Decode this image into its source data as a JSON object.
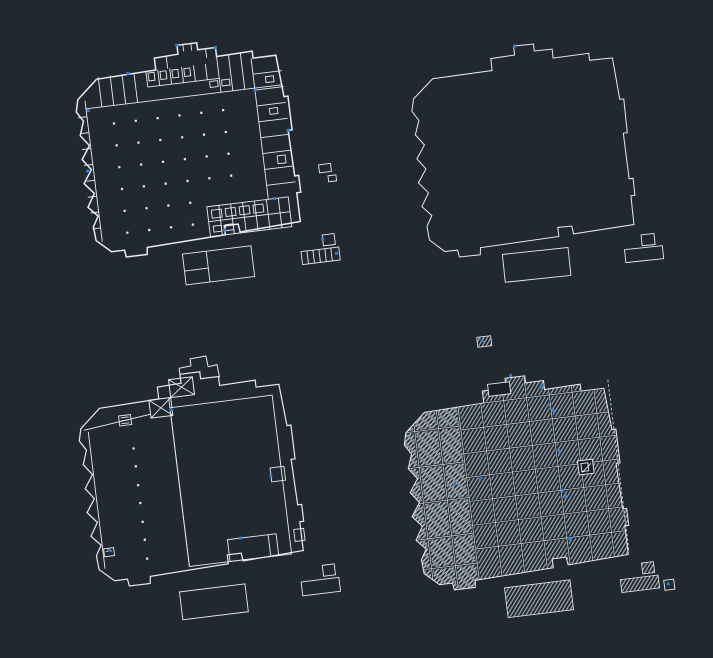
{
  "canvas": {
    "width": 713,
    "height": 658
  },
  "colors": {
    "background": "#212830",
    "line": "#e9ebee",
    "line_dim": "#d6dadf",
    "accent_blue": "#2e7ed2",
    "hatch": "#b9c0c8"
  },
  "footprint_path": "M 28,30 L 88,28 L 88,16 L 112,15 L 112,6 L 132,6 L 132,13 L 150,13 L 150,22 L 186,21 L 186,28 L 209,28 L 212,70 L 216,70 L 216,104 L 212,104 L 213,150 L 217,150 L 217,167 L 213,167 L 213,196 L 152,199 L 151,191 L 137,191 L 137,200 L 58,203 L 57,210 L 36,210 L 35,203 L 22,203 L 8,190 L 7,176 L 13,166 L 4,156 L 12,143 L 3,132 L 12,119 L 4,108 L 13,95 L 5,84 L 10,70 L 4,60 L 7,48 Z",
  "hatch_angles": {
    "left": -27,
    "right": -52
  },
  "plans": [
    {
      "id": "plan-top-left",
      "role": "detailed-floor-plan",
      "transform": "translate(77,39) rotate(-7 108 105)",
      "outline": true,
      "outline_width": 1.5,
      "roof": false,
      "paths": [],
      "lines": [
        [
          14,
          58,
          212,
          58
        ],
        [
          78,
          44,
          150,
          44
        ],
        [
          30,
          28,
          30,
          58
        ],
        [
          42,
          28,
          42,
          58
        ],
        [
          54,
          28,
          54,
          58
        ],
        [
          66,
          28,
          66,
          58
        ],
        [
          78,
          28,
          78,
          44
        ],
        [
          90,
          28,
          90,
          44
        ],
        [
          102,
          28,
          102,
          44
        ],
        [
          114,
          28,
          114,
          44
        ],
        [
          126,
          28,
          126,
          44
        ],
        [
          138,
          28,
          138,
          44
        ],
        [
          150,
          22,
          150,
          58
        ],
        [
          162,
          22,
          162,
          58
        ],
        [
          174,
          22,
          174,
          58
        ],
        [
          100,
          15,
          100,
          28
        ],
        [
          118,
          6,
          118,
          13
        ],
        [
          126,
          6,
          126,
          13
        ],
        [
          140,
          13,
          140,
          22
        ],
        [
          184,
          28,
          184,
          170
        ],
        [
          184,
          44,
          213,
          44
        ],
        [
          184,
          60,
          213,
          60
        ],
        [
          184,
          76,
          213,
          76
        ],
        [
          184,
          92,
          213,
          92
        ],
        [
          184,
          108,
          213,
          108
        ],
        [
          184,
          124,
          213,
          124
        ],
        [
          184,
          140,
          213,
          140
        ],
        [
          184,
          156,
          213,
          156
        ],
        [
          14,
          50,
          14,
          192
        ],
        [
          5,
          66,
          14,
          66
        ],
        [
          5,
          82,
          14,
          82
        ],
        [
          5,
          98,
          14,
          98
        ],
        [
          5,
          114,
          14,
          114
        ],
        [
          6,
          130,
          14,
          130
        ],
        [
          5,
          146,
          14,
          146
        ],
        [
          6,
          162,
          14,
          162
        ],
        [
          6,
          178,
          14,
          178
        ],
        [
          134,
          170,
          134,
          200
        ],
        [
          146,
          170,
          146,
          200
        ],
        [
          158,
          170,
          158,
          200
        ],
        [
          170,
          170,
          170,
          200
        ],
        [
          182,
          170,
          182,
          200
        ],
        [
          194,
          170,
          194,
          200
        ],
        [
          122,
          185,
          204,
          185
        ],
        [
          116,
          214,
          116,
          245
        ],
        [
          92,
          231,
          116,
          231
        ],
        [
          216,
          226,
          216,
          239
        ],
        [
          222,
          226,
          222,
          239
        ],
        [
          228,
          226,
          228,
          239
        ],
        [
          234,
          226,
          234,
          239
        ],
        [
          240,
          226,
          240,
          239
        ]
      ],
      "rects": [
        [
          122,
          170,
          82,
          30
        ],
        [
          92,
          214,
          69,
          31
        ],
        [
          233,
          212,
          12,
          11
        ],
        [
          210,
          226,
          38,
          13
        ],
        [
          238,
          142,
          12,
          8
        ],
        [
          246,
          154,
          8,
          6
        ],
        [
          80,
          30,
          6,
          8
        ],
        [
          92,
          30,
          6,
          8
        ],
        [
          104,
          30,
          6,
          8
        ],
        [
          116,
          30,
          6,
          8
        ],
        [
          140,
          46,
          8,
          6
        ],
        [
          152,
          46,
          8,
          6
        ],
        [
          196,
          48,
          8,
          6
        ],
        [
          196,
          80,
          8,
          6
        ],
        [
          198,
          128,
          8,
          8
        ],
        [
          126,
          174,
          10,
          8
        ],
        [
          140,
          174,
          10,
          8
        ],
        [
          154,
          174,
          10,
          8
        ],
        [
          168,
          174,
          10,
          8
        ],
        [
          126,
          190,
          8,
          6
        ],
        [
          138,
          190,
          8,
          6
        ]
      ],
      "cross_rects": [],
      "hatch_rects": [],
      "dark_rects": [],
      "dashed": [],
      "dots": [
        [
          40,
          76
        ],
        [
          62,
          76
        ],
        [
          84,
          76
        ],
        [
          106,
          76
        ],
        [
          128,
          76
        ],
        [
          150,
          76
        ],
        [
          40,
          98
        ],
        [
          62,
          98
        ],
        [
          84,
          98
        ],
        [
          106,
          98
        ],
        [
          128,
          98
        ],
        [
          150,
          98
        ],
        [
          40,
          120
        ],
        [
          62,
          120
        ],
        [
          84,
          120
        ],
        [
          106,
          120
        ],
        [
          128,
          120
        ],
        [
          150,
          120
        ],
        [
          40,
          142
        ],
        [
          62,
          142
        ],
        [
          84,
          142
        ],
        [
          106,
          142
        ],
        [
          128,
          142
        ],
        [
          150,
          142
        ],
        [
          40,
          164
        ],
        [
          62,
          164
        ],
        [
          84,
          164
        ],
        [
          106,
          164
        ],
        [
          40,
          186
        ],
        [
          62,
          186
        ],
        [
          84,
          186
        ],
        [
          106,
          186
        ]
      ],
      "blue_dots": [
        [
          16,
          60
        ],
        [
          60,
          28
        ],
        [
          150,
          13
        ],
        [
          184,
          60
        ],
        [
          212,
          104
        ],
        [
          190,
          170
        ],
        [
          137,
          195
        ],
        [
          8,
          120
        ],
        [
          112,
          6
        ],
        [
          245,
          232
        ],
        [
          233,
          216
        ]
      ]
    },
    {
      "id": "plan-top-right",
      "role": "building-outline",
      "transform": "translate(412,40) rotate(-6 108 105)",
      "outline": true,
      "outline_width": 1,
      "roof": false,
      "paths": [],
      "lines": [],
      "rects": [
        [
          79,
          212,
          66,
          28
        ],
        [
          219,
          207,
          13,
          11
        ],
        [
          201,
          220,
          38,
          13
        ]
      ],
      "cross_rects": [],
      "hatch_rects": [],
      "dark_rects": [],
      "dashed": [],
      "dots": [],
      "blue_dots": [
        [
          113,
          6
        ]
      ]
    },
    {
      "id": "plan-bottom-left",
      "role": "upper-floor-plan",
      "transform": "translate(80,368) rotate(-7 108 105)",
      "outline": true,
      "outline_width": 1.2,
      "roof": false,
      "paths": [
        "M 112,16 L 112,0 L 124,-1 L 124,-8 L 140,-9 L 141,2 L 150,1 L 151,14"
      ],
      "lines": [
        [
          10,
          50,
          78,
          42
        ],
        [
          14,
          52,
          14,
          190
        ],
        [
          98,
          28,
          98,
          198
        ],
        [
          180,
          176,
          180,
          198
        ],
        [
          48,
          42,
          56,
          42
        ],
        [
          48,
          45,
          56,
          45
        ],
        [
          48,
          48,
          56,
          48
        ],
        [
          17,
          173,
          23,
          173
        ]
      ],
      "rects": [
        [
          98,
          38,
          103,
          160
        ],
        [
          139,
          176,
          49,
          22
        ],
        [
          190,
          110,
          14,
          14
        ],
        [
          206,
          174,
          10,
          12
        ],
        [
          46,
          40,
          12,
          10
        ],
        [
          15,
          170,
          10,
          8
        ],
        [
          85,
          222,
          66,
          28
        ],
        [
          230,
          213,
          12,
          11
        ],
        [
          207,
          227,
          38,
          14
        ]
      ],
      "cross_rects": [
        [
          78,
          28,
          22,
          18
        ],
        [
          100,
          10,
          24,
          18
        ]
      ],
      "hatch_rects": [],
      "dark_rects": [],
      "dashed": [],
      "dots": [
        [
          57,
          74
        ],
        [
          57,
          92
        ],
        [
          57,
          111
        ],
        [
          57,
          129
        ],
        [
          57,
          148
        ],
        [
          57,
          166
        ],
        [
          57,
          185
        ]
      ],
      "blue_dots": [
        [
          99,
          40
        ],
        [
          190,
          117
        ],
        [
          20,
          172
        ],
        [
          152,
          176
        ]
      ]
    },
    {
      "id": "plan-bottom-right",
      "role": "roof-plan",
      "transform": "translate(405,372) rotate(-7 108 105)",
      "outline": true,
      "outline_width": 1,
      "roof": true,
      "ridge_x": 62,
      "paths": [],
      "seams": [
        [
          16,
          0,
          16,
          205
        ],
        [
          40,
          -2,
          40,
          205
        ],
        [
          62,
          -5,
          62,
          205
        ],
        [
          85,
          -5,
          85,
          203
        ],
        [
          108,
          -8,
          108,
          202
        ],
        [
          131,
          -5,
          131,
          201
        ],
        [
          154,
          0,
          154,
          200
        ],
        [
          177,
          2,
          177,
          199
        ],
        [
          199,
          6,
          199,
          198
        ],
        [
          62,
          28,
          218,
          28
        ],
        [
          62,
          52,
          218,
          52
        ],
        [
          62,
          76,
          218,
          76
        ],
        [
          62,
          100,
          218,
          100
        ],
        [
          62,
          124,
          218,
          124
        ],
        [
          62,
          148,
          218,
          148
        ],
        [
          62,
          172,
          218,
          172
        ],
        [
          -2,
          48,
          62,
          48
        ],
        [
          -2,
          84,
          62,
          84
        ],
        [
          -2,
          120,
          62,
          120
        ],
        [
          -2,
          156,
          62,
          156
        ],
        [
          0,
          186,
          62,
          186
        ]
      ],
      "lines": [
        [
          177,
          109,
          187,
          101
        ]
      ],
      "rects": [
        [
          245,
          226,
          10,
          10
        ]
      ],
      "cross_rects": [],
      "hatch_rects": [
        [
          89,
          -38,
          14,
          10
        ],
        [
          86,
          214,
          66,
          30
        ],
        [
          225,
          206,
          12,
          11
        ],
        [
          202,
          220,
          38,
          13
        ]
      ],
      "dark_rects": [
        [
          174,
          97,
          15,
          14
        ],
        [
          94,
          10,
          22,
          12
        ]
      ],
      "white_rects": [
        [
          177,
          100,
          7,
          8
        ]
      ],
      "dashed": [
        [
          214,
          20,
          214,
          194
        ]
      ],
      "dots": [],
      "blue_dots": [
        [
          147,
          19
        ],
        [
          152,
          38
        ],
        [
          156,
          44
        ],
        [
          157,
          85
        ],
        [
          49,
          105
        ],
        [
          75,
          103
        ],
        [
          156,
          124
        ],
        [
          158,
          131
        ],
        [
          157,
          173
        ],
        [
          118,
          4
        ],
        [
          249,
          230
        ],
        [
          94,
          -34
        ]
      ]
    }
  ]
}
